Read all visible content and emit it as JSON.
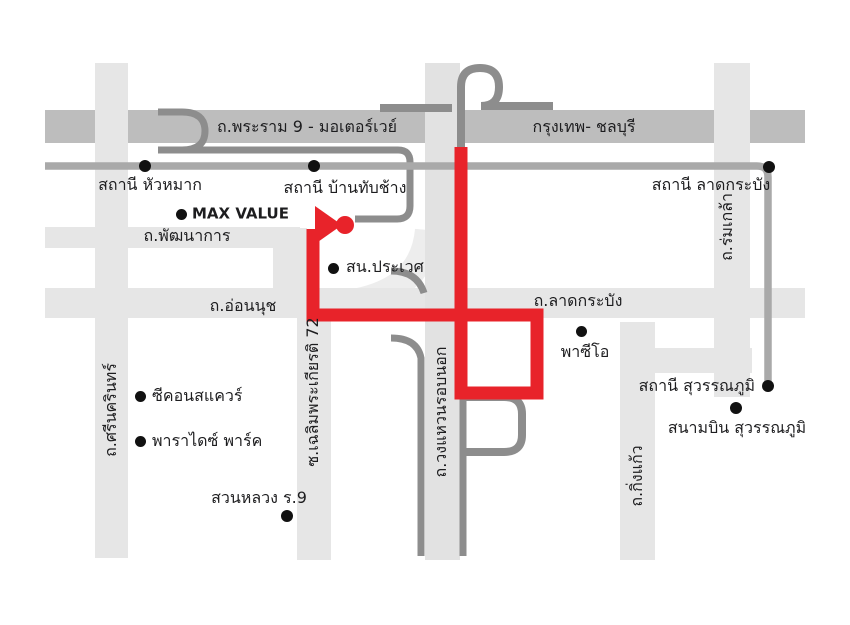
{
  "map": {
    "description": "Schematic driving-direction map, east Bangkok / Suvarnabhumi area",
    "background": "#ffffff"
  },
  "colors": {
    "route_red": "#e8232a",
    "road_light": "#e6e6e6",
    "road_lighter": "#ececec",
    "motorway_band": "#bdbdbd",
    "ring_road_fill": "#e2e2e2",
    "ramp_dark": "#8d8d8d",
    "rail_gray": "#a9a9a9",
    "marker_dot": "#111111",
    "text": "#1d1d1f"
  },
  "route": {
    "points": "313,229 313,315 537,315 537,393 461,393 461,147",
    "stroke_width": 13
  },
  "destination_marker": {
    "arrow_points": "315,206 315,244 342,225",
    "dot_cx": 345,
    "dot_cy": 225,
    "dot_r": 9
  },
  "labels": [
    {
      "id": "road-rama9-motorway",
      "text": "ถ.พระราม 9 - มอเตอร์เวย์",
      "x": 307,
      "y": 127,
      "anchor": "middle",
      "rotate": 0
    },
    {
      "id": "road-bangkok-chonburi",
      "text": "กรุงเทพ- ชลบุรี",
      "x": 584,
      "y": 127,
      "anchor": "middle",
      "rotate": 0
    },
    {
      "id": "station-hua-mak",
      "text": "สถานี หัวหมาก",
      "x": 150,
      "y": 185,
      "anchor": "middle",
      "rotate": 0
    },
    {
      "id": "station-ban-thap-chang",
      "text": "สถานี บ้านทับช้าง",
      "x": 345,
      "y": 188,
      "anchor": "middle",
      "rotate": 0
    },
    {
      "id": "station-lat-krabang",
      "text": "สถานี ลาดกระบัง",
      "x": 711,
      "y": 185,
      "anchor": "middle",
      "rotate": 0
    },
    {
      "id": "poi-max-value",
      "text": "MAX VALUE",
      "x": 192,
      "y": 214,
      "anchor": "start",
      "rotate": 0,
      "en": true
    },
    {
      "id": "road-phatthanakan",
      "text": "ถ.พัฒนาการ",
      "x": 187,
      "y": 236,
      "anchor": "middle",
      "rotate": 0
    },
    {
      "id": "poi-prawet-police",
      "text": "สน.ประเวศ",
      "x": 346,
      "y": 267,
      "anchor": "start",
      "rotate": 0
    },
    {
      "id": "road-on-nut",
      "text": "ถ.อ่อนนุช",
      "x": 243,
      "y": 306,
      "anchor": "middle",
      "rotate": 0
    },
    {
      "id": "road-lat-krabang",
      "text": "ถ.ลาดกระบัง",
      "x": 578,
      "y": 301,
      "anchor": "middle",
      "rotate": 0
    },
    {
      "id": "poi-paseo",
      "text": "พาซีโอ",
      "x": 585,
      "y": 352,
      "anchor": "middle",
      "rotate": 0
    },
    {
      "id": "station-suvarnabhumi",
      "text": "สถานี สุวรรณภูมิ",
      "x": 755,
      "y": 386,
      "anchor": "end",
      "rotate": 0
    },
    {
      "id": "poi-suvarnabhumi-airport",
      "text": "สนามบิน สุวรรณภูมิ",
      "x": 737,
      "y": 428,
      "anchor": "middle",
      "rotate": 0
    },
    {
      "id": "poi-seacon-square",
      "text": "ซีคอนสแควร์",
      "x": 152,
      "y": 396,
      "anchor": "start",
      "rotate": 0
    },
    {
      "id": "poi-paradise-park",
      "text": "พาราไดซ์ พาร์ค",
      "x": 152,
      "y": 441,
      "anchor": "start",
      "rotate": 0
    },
    {
      "id": "poi-suan-luang-r9",
      "text": "สวนหลวง ร.9",
      "x": 259,
      "y": 498,
      "anchor": "middle",
      "rotate": 0
    },
    {
      "id": "road-srinakarin",
      "text": "ถ.ศรีนครินทร์",
      "x": 111,
      "y": 410,
      "anchor": "middle",
      "rotate": -90
    },
    {
      "id": "road-chalerm-prakiat-72",
      "text": "ซ.เฉลิมพระเกียรติ 72",
      "x": 313,
      "y": 392,
      "anchor": "middle",
      "rotate": -90
    },
    {
      "id": "road-rom-klao",
      "text": "ถ.ร่มเกล้า",
      "x": 727,
      "y": 227,
      "anchor": "middle",
      "rotate": -90
    },
    {
      "id": "road-outer-ring",
      "text": "ถ.วงแหวนรอบนอก",
      "x": 441,
      "y": 412,
      "anchor": "middle",
      "rotate": -90
    },
    {
      "id": "road-king-kaew",
      "text": "ถ.กิ่งแก้ว",
      "x": 637,
      "y": 476,
      "anchor": "middle",
      "rotate": -90
    }
  ],
  "dots": [
    {
      "id": "dot-station-hua-mak",
      "cx": 145,
      "cy": 166,
      "r": 6
    },
    {
      "id": "dot-station-ban-thap-chang",
      "cx": 314,
      "cy": 166,
      "r": 6
    },
    {
      "id": "dot-station-lat-krabang",
      "cx": 769,
      "cy": 167,
      "r": 6
    },
    {
      "id": "dot-station-suvarnabhumi",
      "cx": 768,
      "cy": 386,
      "r": 6
    },
    {
      "id": "dot-max-value",
      "cx": 181,
      "cy": 214,
      "r": 5.5
    },
    {
      "id": "dot-prawet-police",
      "cx": 333,
      "cy": 268,
      "r": 5.5
    },
    {
      "id": "dot-paseo",
      "cx": 581,
      "cy": 331,
      "r": 5.5
    },
    {
      "id": "dot-suvarnabhumi-airport",
      "cx": 736,
      "cy": 408,
      "r": 6
    },
    {
      "id": "dot-seacon-square",
      "cx": 140,
      "cy": 396,
      "r": 5.5
    },
    {
      "id": "dot-paradise-park",
      "cx": 140,
      "cy": 441,
      "r": 5.5
    },
    {
      "id": "dot-suan-luang-r9",
      "cx": 287,
      "cy": 516,
      "r": 6
    }
  ]
}
